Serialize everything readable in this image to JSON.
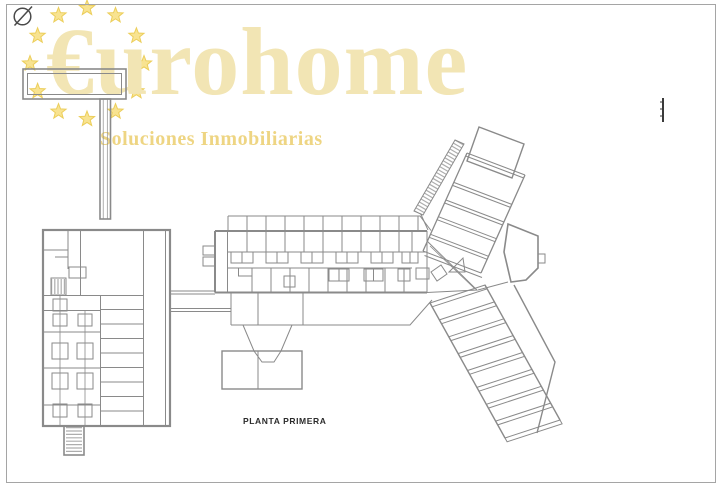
{
  "page": {
    "background_color": "#ffffff",
    "border_color": "#a5a5a5"
  },
  "watermark_logo": {
    "title": "€urohome",
    "subtitle": "Soluciones Inmobiliarias",
    "title_color": "#f2e5b4",
    "subtitle_color": "#eed583",
    "stars": {
      "count": 12,
      "fill": "#f8e391",
      "stroke": "#ecce5a"
    }
  },
  "drawing": {
    "label": "PLANTA PRIMERA",
    "label_color": "#2b2b2b",
    "line_color": "#8a8a8a",
    "annotation_icons": [
      "no-entry-icon",
      "scale-mark-icon"
    ]
  }
}
